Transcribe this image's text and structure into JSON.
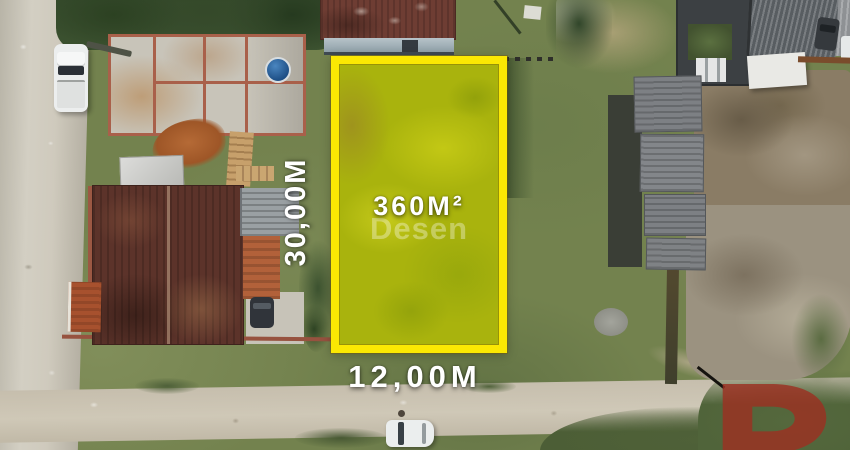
{
  "meta": {
    "title": "Aerial drone photo of land lot for sale",
    "image_width": 850,
    "image_height": 450
  },
  "overlay": {
    "area_label": "360M²",
    "height_label": "30,00M",
    "width_label": "12,00M",
    "watermark": "Desen",
    "highlight_border_color": "#fbe803",
    "highlight_fill_color": "#a9b30d",
    "label_text_color": "#ffffff",
    "brand_logo_color": "#9c3122"
  },
  "scene": {
    "elements": [
      "gravel-road-left",
      "dirt-road-bottom",
      "construction-site",
      "white-truck",
      "crane-arm",
      "water-tank",
      "dirt-pile",
      "lumber-stacks",
      "house-dark-roof",
      "metal-roof-section",
      "orange-roof-section",
      "orange-roof-shed",
      "driveway",
      "parked-dark-car",
      "house-top-roof",
      "warehouse-dark",
      "big-corrugated-roof",
      "white-canopy",
      "townhouse-row",
      "dirt-field",
      "white-car-bottom",
      "highlighted-lot",
      "desen-logo-d",
      "trees",
      "grass"
    ]
  }
}
